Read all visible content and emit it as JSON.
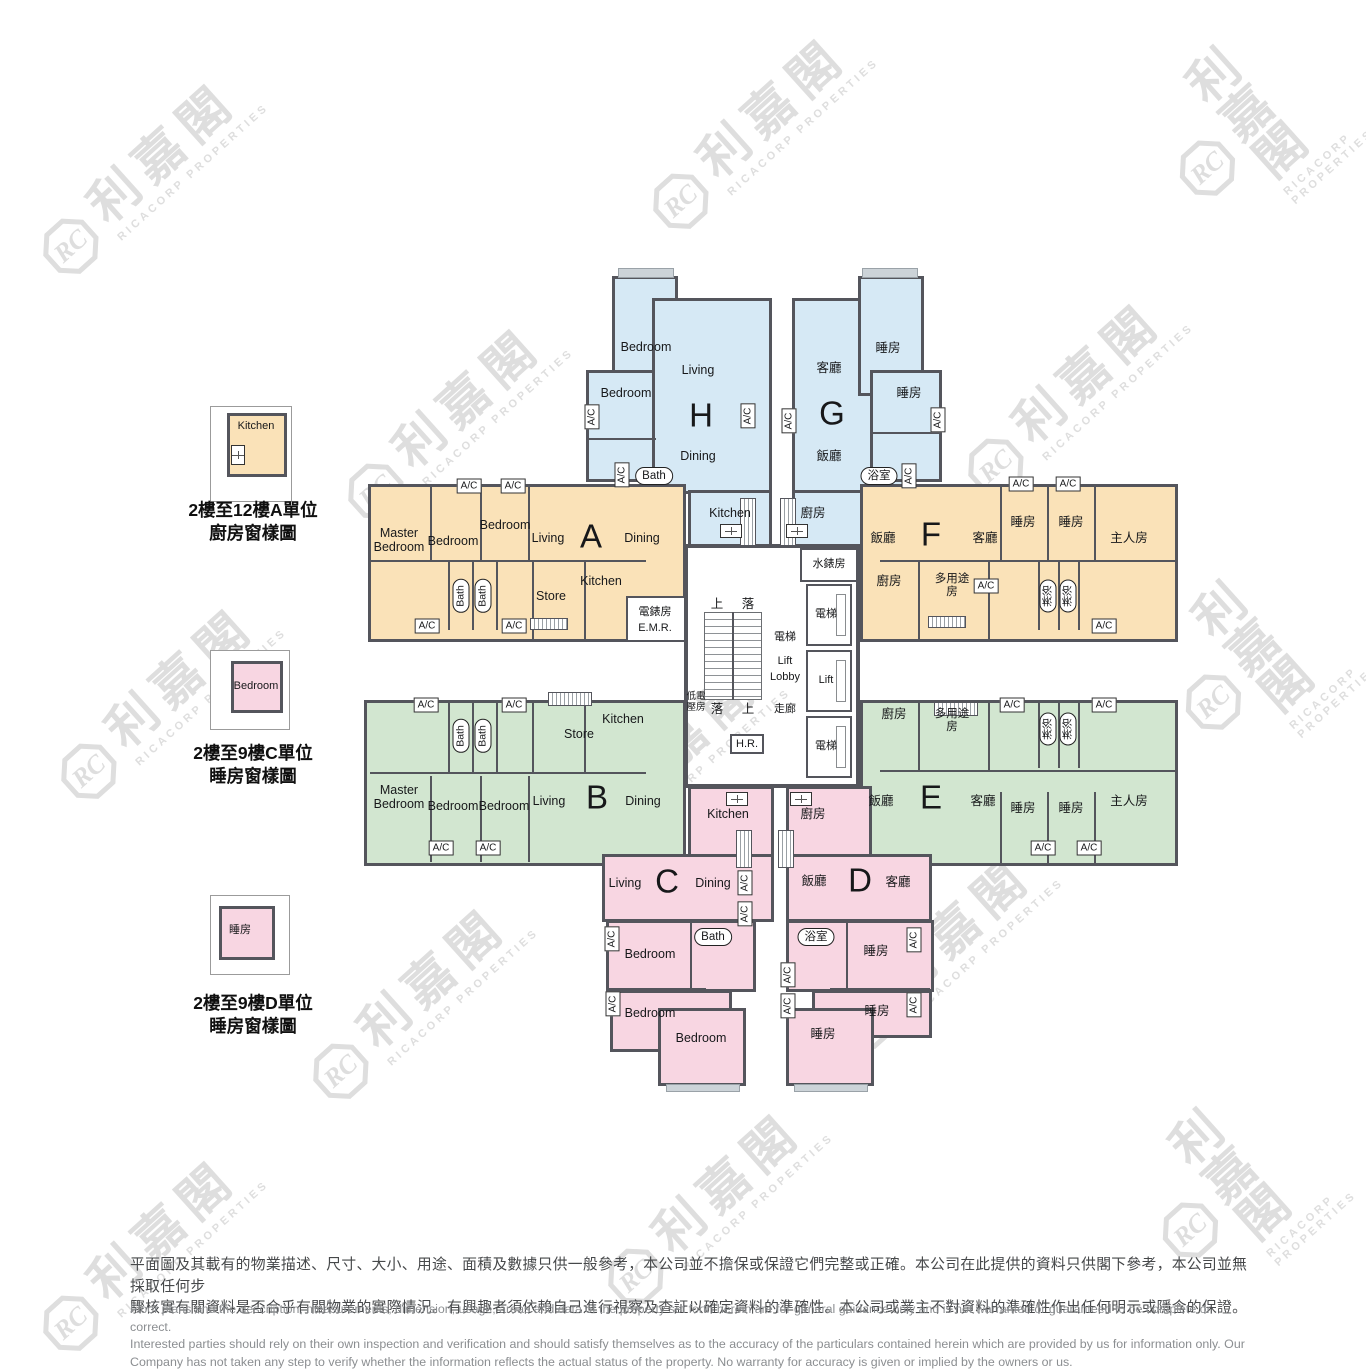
{
  "watermark": {
    "cn": "利嘉閣",
    "en": "RICACORP PROPERTIES",
    "monogram": "RC"
  },
  "legend": [
    {
      "room": "Kitchen",
      "caption1": "2樓至12樓A單位",
      "caption2": "廚房窗樣圖"
    },
    {
      "room": "Bedroom",
      "caption1": "2樓至9樓C單位",
      "caption2": "睡房窗樣圖"
    },
    {
      "room": "睡房",
      "caption1": "2樓至9樓D單位",
      "caption2": "睡房窗樣圖"
    }
  ],
  "common": {
    "ac": "A/C"
  },
  "core": {
    "water_meter": "水錶房",
    "lift_cn": "電梯",
    "lift_en": "Lift",
    "lobby_cn": "電梯",
    "lobby_line1": "Lift",
    "lobby_line2": "Lobby",
    "corridor": "走廊",
    "up": "上",
    "down": "落",
    "low_voltage": "低電壓房",
    "hose_reel": "H.R."
  },
  "units": {
    "A": {
      "letter": "A",
      "master": "Master Bedroom",
      "bedroom": "Bedroom",
      "living": "Living",
      "dining": "Dining",
      "store": "Store",
      "kitchen": "Kitchen",
      "bath": "Bath",
      "emr_cn": "電錶房",
      "emr_en": "E.M.R."
    },
    "B": {
      "letter": "B",
      "master": "Master Bedroom",
      "bedroom": "Bedroom",
      "living": "Living",
      "dining": "Dining",
      "store": "Store",
      "kitchen": "Kitchen",
      "bath": "Bath"
    },
    "C": {
      "letter": "C",
      "kitchen": "Kitchen",
      "living": "Living",
      "dining": "Dining",
      "bath": "Bath",
      "bedroom": "Bedroom"
    },
    "D": {
      "letter": "D",
      "kitchen": "廚房",
      "dining": "飯廳",
      "living": "客廳",
      "bath": "浴室",
      "bedroom": "睡房"
    },
    "E": {
      "letter": "E",
      "kitchen": "廚房",
      "utility": "多用途房",
      "dining": "飯廳",
      "living": "客廳",
      "bedroom": "睡房",
      "master": "主人房",
      "shower": "淋浴"
    },
    "F": {
      "letter": "F",
      "kitchen": "廚房",
      "utility": "多用途房",
      "dining": "飯廳",
      "living": "客廳",
      "bedroom": "睡房",
      "master": "主人房",
      "shower": "淋浴"
    },
    "G": {
      "letter": "G",
      "living": "客廳",
      "bedroom": "睡房",
      "dining": "飯廳",
      "kitchen": "廚房",
      "bath": "浴室"
    },
    "H": {
      "letter": "H",
      "bedroom": "Bedroom",
      "living": "Living",
      "dining": "Dining",
      "kitchen": "Kitchen",
      "bath": "Bath"
    }
  },
  "disclaimer": {
    "cn1": "平面圖及其載有的物業描述、尺寸、大小、用途、面積及數據只供一般參考，本公司並不擔保或保證它們完整或正確。本公司在此提供的資料只供閣下參考，本公司並無採取任何步",
    "cn2": "驟核實有關資料是否合乎有關物業的實際情況。有興趣者須依賴自己進行視察及查証以確定資料的準確性。本公司或業主不對資料的準確性作出任何明示或隱含的保證。",
    "en1": "Floor plans and the description, measurements, dimension, usage, areas and data of the property set forth herein are for general guidance only and is not warranted or guaranteed to be complete or correct.",
    "en2": "Interested parties should rely on their own inspection and verification and should satisfy themselves as to the accuracy of the particulars contained herein which are provided by us for information only.  Our",
    "en3": "Company has not taken any step to verify whether the information reflects the actual status of the property.  No warranty for accuracy is given or implied by the owners or us."
  }
}
